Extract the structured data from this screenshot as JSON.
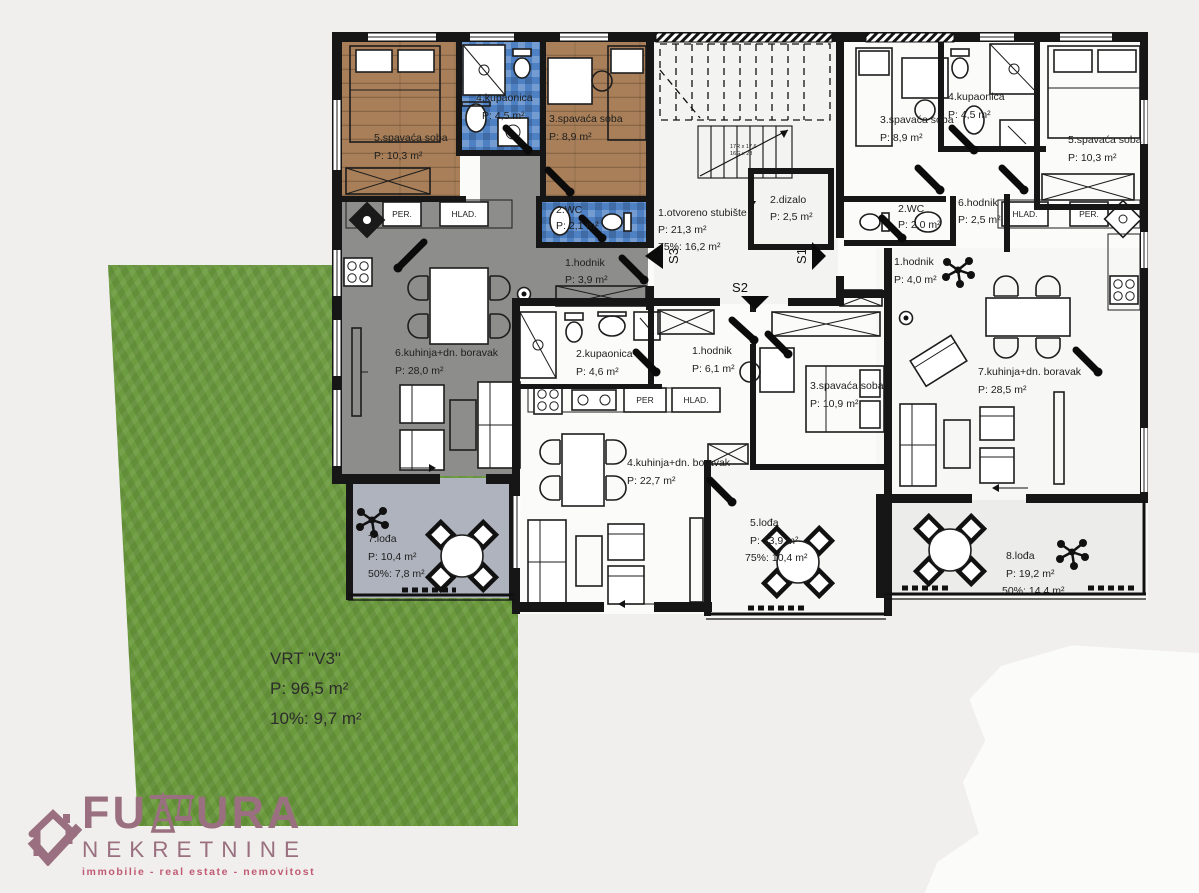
{
  "colors": {
    "bg": "#f0efed",
    "wall": "#161616",
    "wood": "#a87f58",
    "tile": "#4e80c4",
    "floorgray": "#8d8d8c",
    "loggia": "#aeb3bd",
    "grass": "#6b9a3d",
    "brand": "#9a7080",
    "brandpink": "#c05a74"
  },
  "rooms": {
    "a1": {
      "name": "1.hodnik",
      "l1": "P: 3,9 m²"
    },
    "a2": {
      "name": "2.WC",
      "l1": "P: 2,1 m²"
    },
    "a3": {
      "name": "3.spavaća soba",
      "l1": "P: 8,9 m²"
    },
    "a4": {
      "name": "4.kupaonica",
      "l1": "P: 4,5 m²"
    },
    "a5": {
      "name": "5.spavaća soba",
      "l1": "P: 10,3 m²"
    },
    "a6": {
      "name": "6.kuhinja+dn. boravak",
      "l1": "P: 28,0 m²"
    },
    "a7": {
      "name": "7.lođa",
      "l1": "P: 10,4 m²",
      "l2": "50%: 7,8 m²"
    },
    "s1": {
      "name": "1.otvoreno stubište",
      "l1": "P: 21,3 m²",
      "l2": "75%: 16,2 m²"
    },
    "s2": {
      "name": "2.dizalo",
      "l1": "P: 2,5 m²"
    },
    "b1": {
      "name": "1.hodnik",
      "l1": "P: 6,1 m²"
    },
    "b2": {
      "name": "2.kupaonica",
      "l1": "P: 4,6 m²"
    },
    "b3": {
      "name": "3.spavaća soba",
      "l1": "P: 10,9 m²"
    },
    "b4": {
      "name": "4.kuhinja+dn. boravak",
      "l1": "P: 22,7 m²"
    },
    "b5": {
      "name": "5.lođa",
      "l1": "P: 13,9 m²",
      "l2": "75%: 10,4 m²"
    },
    "c1": {
      "name": "1.hodnik",
      "l1": "P: 4,0 m²"
    },
    "c2": {
      "name": "2.WC",
      "l1": "P: 2,0 m²"
    },
    "c3": {
      "name": "3.spavaća soba",
      "l1": "P: 8,9 m²"
    },
    "c4": {
      "name": "4.kupaonica",
      "l1": "P: 4,5 m²"
    },
    "c5": {
      "name": "5.spavaća soba",
      "l1": "P: 10,3 m²"
    },
    "c6": {
      "name": "6.hodnik",
      "l1": "P: 2,5 m²"
    },
    "c7": {
      "name": "7.kuhinja+dn. boravak",
      "l1": "P: 28,5 m²"
    },
    "c8": {
      "name": "8.lođa",
      "l1": "P: 19,2 m²",
      "l2": "50%: 14,4 m²"
    }
  },
  "labels": {
    "per_a": "PER.",
    "hlad_a": "HLAD.",
    "per_b": "PER",
    "hlad_b": "HLAD.",
    "hlad_c": "HLAD.",
    "per_c": "PER."
  },
  "arrows": {
    "s1": "S1",
    "s2": "S2",
    "s3": "S3"
  },
  "stairs": {
    "dim1": "17R x 17,6",
    "dim2": "16G x 28"
  },
  "garden": {
    "title": "VRT \"V3\"",
    "l1": "P: 96,5 m²",
    "l2": "10%: 9,7 m²"
  },
  "logo": {
    "brand": "FUTURA",
    "brand_prefix": "FU",
    "brand_suffix": "URA",
    "line2": "NEKRETNINE",
    "tagline": "immobilie - real estate - nemovitost"
  }
}
